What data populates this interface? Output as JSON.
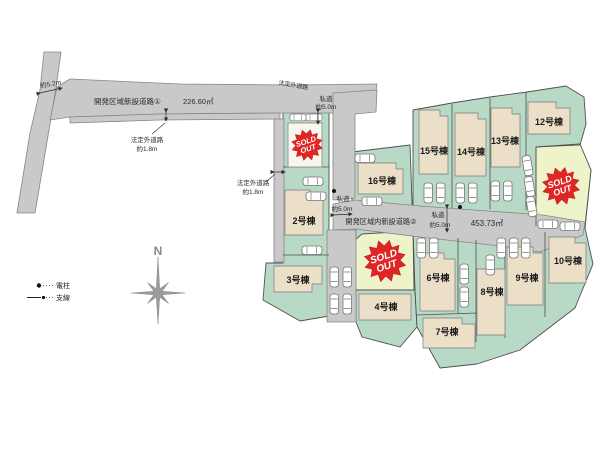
{
  "plan": {
    "compass_n": "N",
    "legend": {
      "pole": "電柱",
      "wire": "支線"
    },
    "badge": {
      "line1": "SOLD",
      "line2": "OUT"
    },
    "roads": {
      "road1_name": "開発区域新設道路①",
      "road1_area": "226.60㎡",
      "road2_name": "開発区域内新設道路②",
      "road2_area": "453.73㎡",
      "width_52": "約5.2m",
      "legal_road": "法定外道路",
      "legal_width": "約1.8m",
      "private_road": "私道",
      "private_width": "約5.0m"
    },
    "lots": {
      "l2": "2号棟",
      "l3": "3号棟",
      "l4": "4号棟",
      "l6": "6号棟",
      "l7": "7号棟",
      "l8": "8号棟",
      "l9": "9号棟",
      "l10": "10号棟",
      "l12": "12号棟",
      "l13": "13号棟",
      "l14": "14号棟",
      "l15": "15号棟",
      "l16": "16号棟"
    },
    "colors": {
      "road": "#c9c9c9",
      "lot_green": "#b7d9c6",
      "lot_sold_bg": "#eff3c9",
      "building": "#ecdfc8",
      "badge_red": "#e02525"
    }
  }
}
